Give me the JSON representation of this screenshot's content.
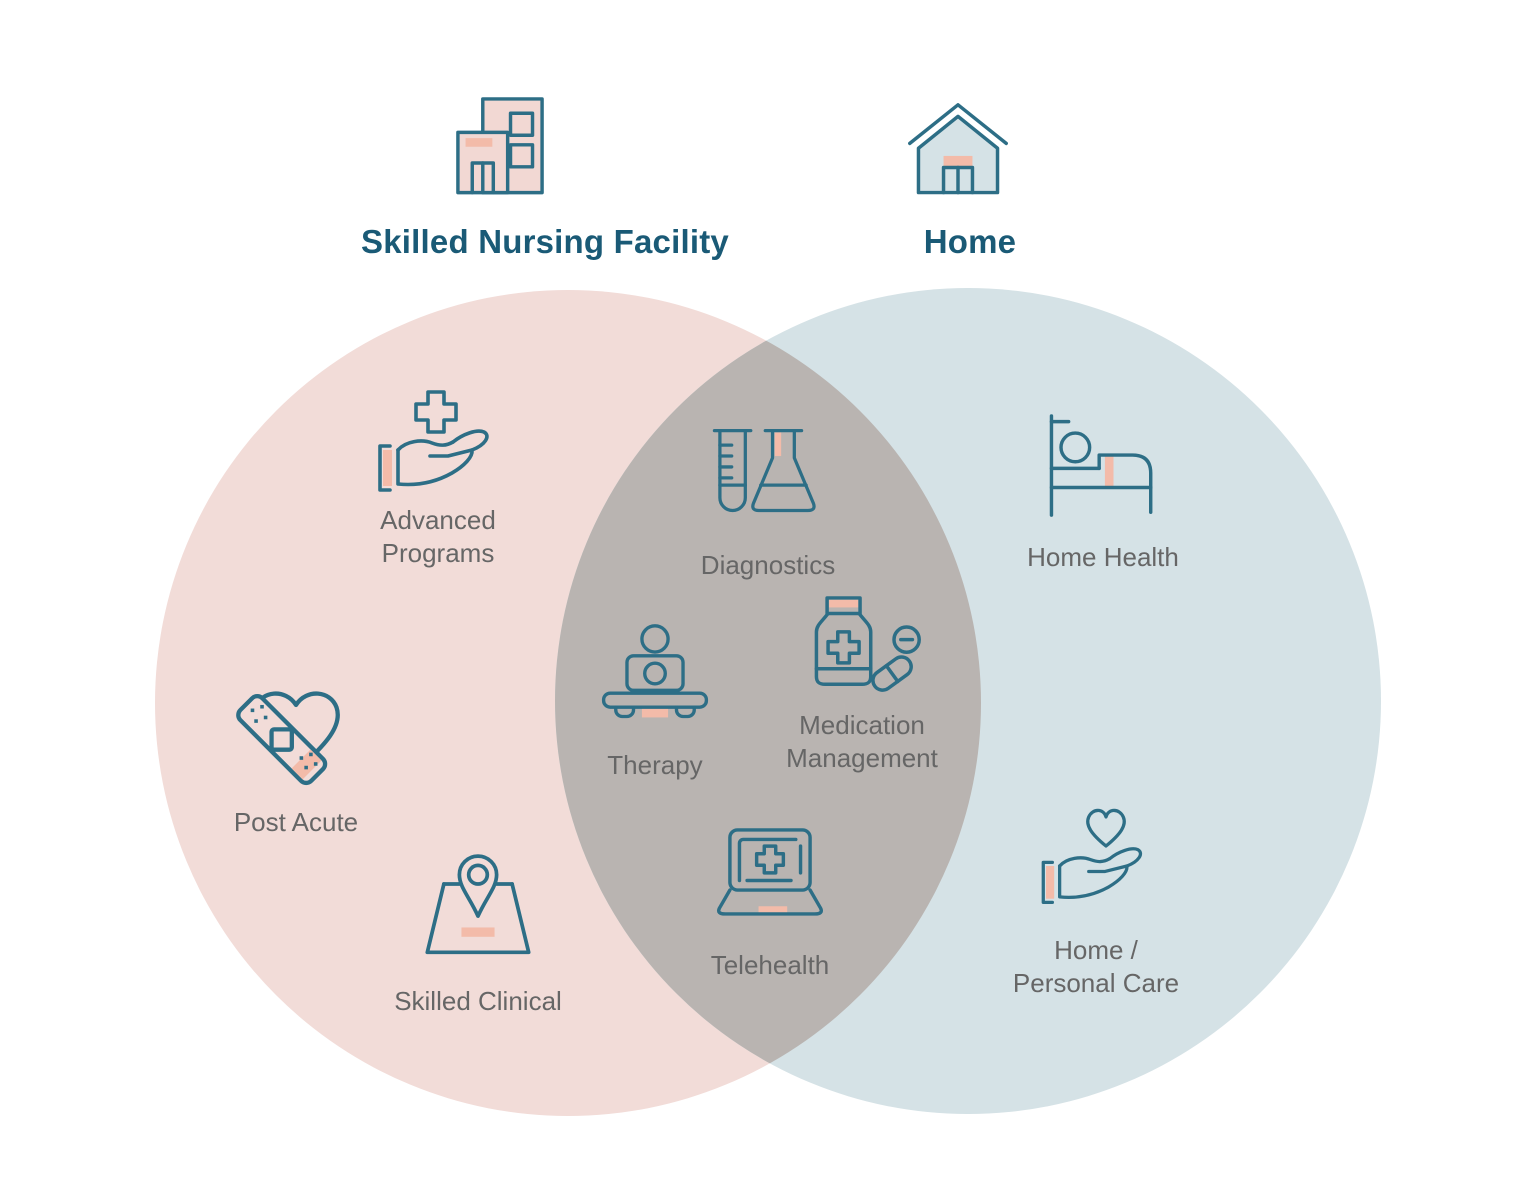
{
  "diagram": {
    "type": "venn",
    "regions": {
      "snf_only": {
        "label": "Skilled Nursing Facility",
        "icon": "building-icon",
        "items": [
          {
            "icon": "hand-plus-icon",
            "label": "Advanced Programs"
          },
          {
            "icon": "heart-bandage-icon",
            "label": "Post Acute"
          },
          {
            "icon": "map-pin-icon",
            "label": "Skilled Clinical"
          }
        ]
      },
      "overlap": {
        "items": [
          {
            "icon": "test-tube-flask-icon",
            "label": "Diagnostics"
          },
          {
            "icon": "person-laptop-icon",
            "label": "Therapy"
          },
          {
            "icon": "medication-bottle-icon",
            "label": "Medication Management"
          },
          {
            "icon": "laptop-medical-icon",
            "label": "Telehealth"
          }
        ]
      },
      "home_only": {
        "label": "Home",
        "icon": "house-icon",
        "items": [
          {
            "icon": "patient-bed-icon",
            "label": "Home Health"
          },
          {
            "icon": "hand-heart-icon",
            "label": "Home / Personal Care"
          }
        ]
      }
    },
    "colors": {
      "background": "#ffffff",
      "snf_circle": "#f2dcd8",
      "home_circle": "#d5e2e6",
      "overlap": "#b9b4b1",
      "icon_stroke": "#2d6e86",
      "title_text": "#1a5a76",
      "label_text": "#666666",
      "accent": "#f3bba9",
      "building_fill": "#f2d8d3"
    }
  }
}
